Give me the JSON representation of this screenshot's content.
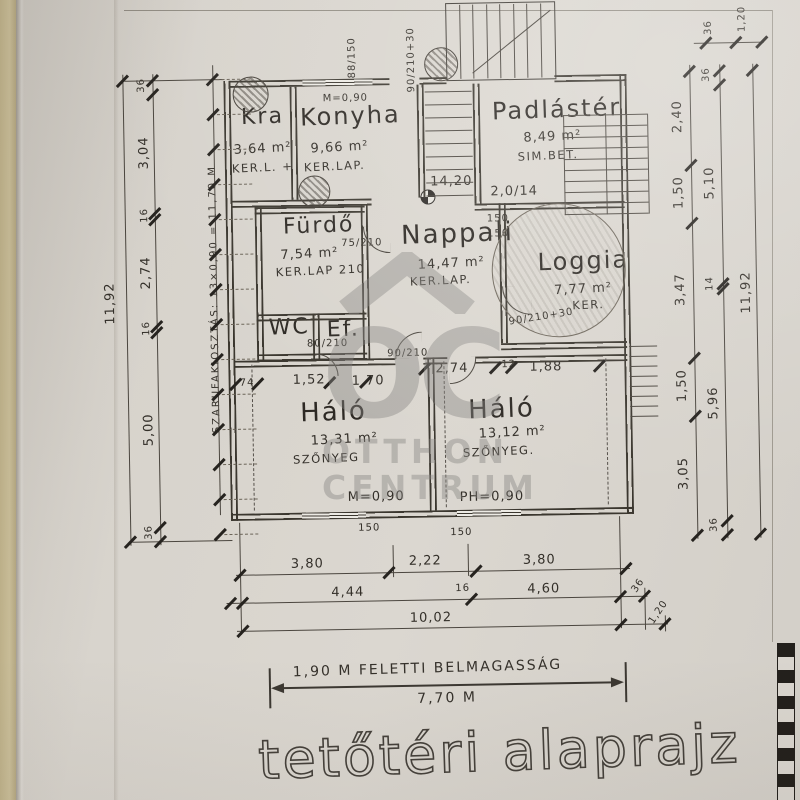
{
  "sheet": {
    "title": "tetőtéri alaprajz",
    "height_note": "1,90 M FELETTI BELMAGASSÁG",
    "height_value": "7,70 M"
  },
  "watermark": {
    "monogram": "OC",
    "line1": "OTTHON",
    "line2": "CENTRUM"
  },
  "rooms": {
    "kamra": {
      "name": "Kra",
      "area": "3,64 m²",
      "finish": "KER.L. +"
    },
    "konyha": {
      "name": "Konyha",
      "area": "9,66 m²",
      "finish": "KER.LAP."
    },
    "padlaster": {
      "name": "Padlástér",
      "area": "8,49 m²",
      "finish": "SIM.BET.",
      "beam": "2,0/14"
    },
    "furdo": {
      "name": "Fürdő",
      "area": "7,54 m²",
      "finish": "KER.LAP 210"
    },
    "nappali": {
      "name": "Nappali",
      "area": "14,47 m²",
      "finish": "KER.LAP.",
      "level": "14,20"
    },
    "loggia": {
      "name": "Loggia",
      "area": "7,77 m²",
      "finish": "KER.",
      "door": "90/210+30"
    },
    "wc": {
      "name": "WC"
    },
    "eloter": {
      "name": "Ef."
    },
    "halo_left": {
      "name": "Háló",
      "area": "13,31 m²",
      "finish": "SZŐNYEG"
    },
    "halo_right": {
      "name": "Háló",
      "area": "13,12 m²",
      "finish": "SZŐNYEG."
    }
  },
  "annotations": {
    "top_window": "88/150",
    "top_door": "90/210+30",
    "top_parapet": "M=0,90",
    "parapet_left": "M=0,90",
    "parapet_right": "PH=0,90",
    "door_furdo": "75/210",
    "door_wc": "80/210",
    "door_halo": "90/210",
    "window_150a": "150",
    "window_150b": "150",
    "window_150c": "150",
    "window_150d": "150"
  },
  "dims": {
    "left_total": "11,92",
    "left_chain": [
      "36",
      "3,04",
      "16",
      "2,74",
      "16",
      "5,00",
      "36"
    ],
    "rafter_note": "SZARUFAKIOSZTÁS: 13×0,90 = 11,70 M",
    "right_inner": [
      "2,40",
      "1,50",
      "3,47",
      "1,50",
      "3,05"
    ],
    "right_mid": [
      "36",
      "5,10",
      "14",
      "5,96",
      "36"
    ],
    "right_total": "11,92",
    "corner_top_right": [
      "36",
      "1,20"
    ],
    "inner_row_left": [
      "74",
      "1,52",
      "1,70"
    ],
    "inner_row_right": [
      "2,74",
      "12",
      "1,88"
    ],
    "bottom_row1": [
      "3,80",
      "2,22",
      "3,80"
    ],
    "bottom_row2": [
      "4,44",
      "16",
      "4,60"
    ],
    "bottom_row2_right": "36",
    "bottom_total": "10,02",
    "bottom_right": "1,20"
  }
}
